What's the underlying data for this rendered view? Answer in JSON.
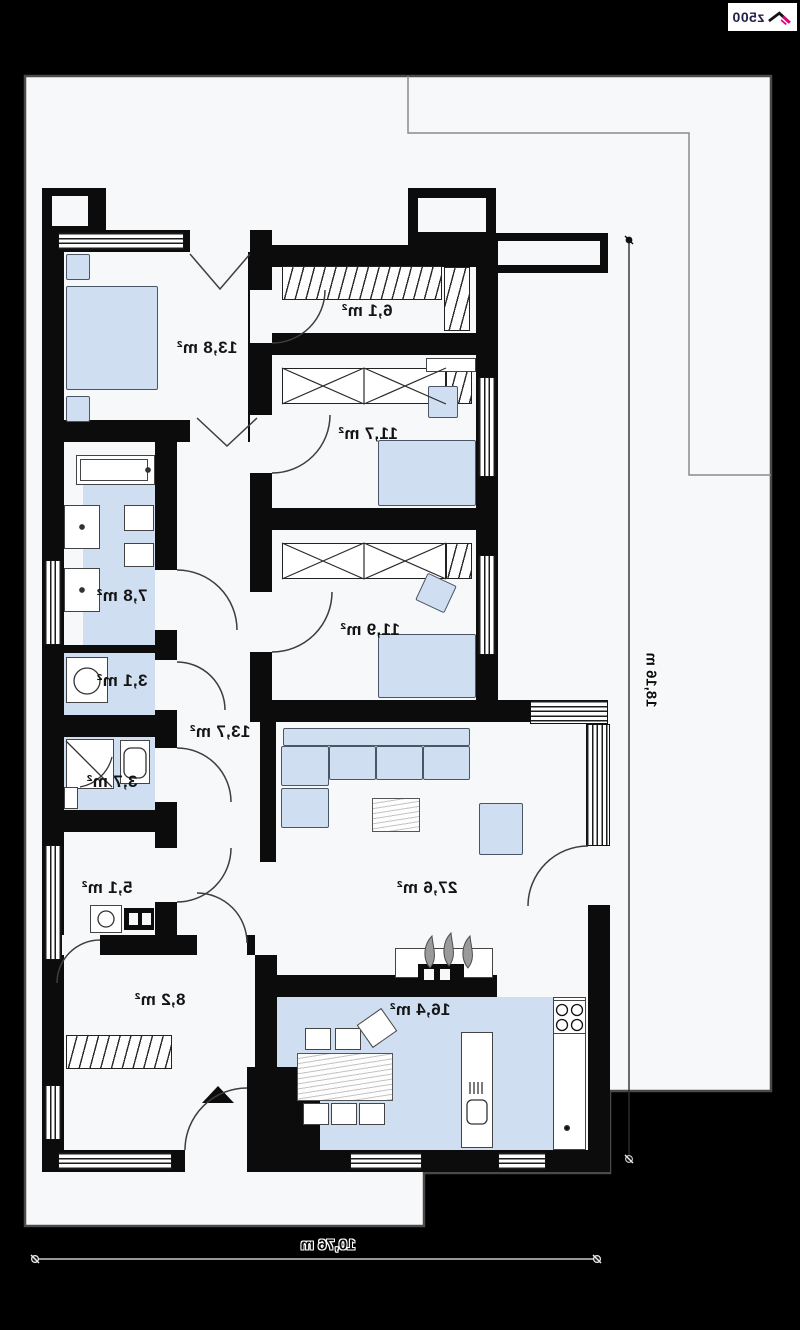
{
  "logo": {
    "text": "z500"
  },
  "rooms": [
    {
      "name": "master-bedroom",
      "area": "13,8 m²"
    },
    {
      "name": "wardrobe",
      "area": "6,1 m²"
    },
    {
      "name": "bedroom-2",
      "area": "11,7 m²"
    },
    {
      "name": "bedroom-3",
      "area": "11,9 m²"
    },
    {
      "name": "bathroom",
      "area": "7,8 m²"
    },
    {
      "name": "laundry",
      "area": "3,1 m²"
    },
    {
      "name": "shower-room",
      "area": "3,7 m²"
    },
    {
      "name": "office",
      "area": "5,1 m²"
    },
    {
      "name": "hall",
      "area": "8,2 m²"
    },
    {
      "name": "corridor",
      "area": "13,7 m²"
    },
    {
      "name": "living-room",
      "area": "27,6 m²"
    },
    {
      "name": "kitchen-dining",
      "area": "16,4 m²"
    }
  ],
  "dimensions": {
    "height": "18,16 m",
    "width": "10,76 m"
  },
  "colors": {
    "background": "#000000",
    "lot": "#f7f8fa",
    "wall": "#0c0c0c",
    "furniture_blue": "#cfdef0",
    "logo_accent": "#e6007e"
  }
}
